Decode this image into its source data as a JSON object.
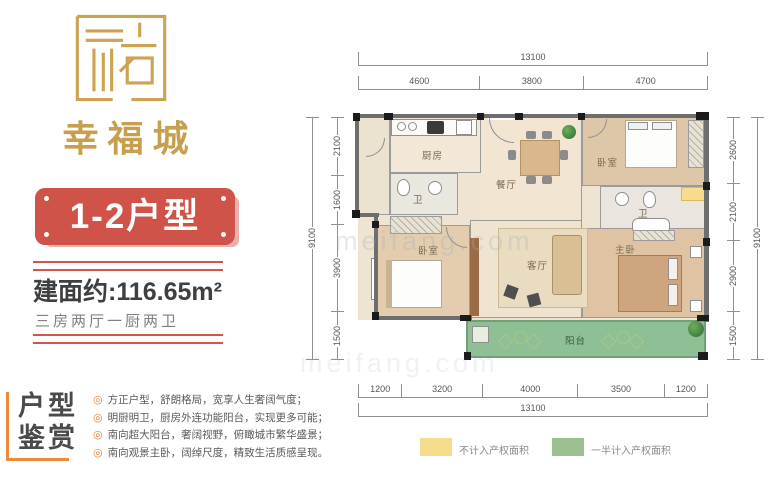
{
  "branding": {
    "logo_text": "幸福城",
    "banner_label": "1-2户型"
  },
  "summary": {
    "area_text": "建面约:116.65m²",
    "layout_text": "三房两厅一厨两卫"
  },
  "appreciation": {
    "title_line1": "户型",
    "title_line2": "鉴赏",
    "items": [
      "方正户型，舒朗格局，宽享人生奢阔气度；",
      "明厨明卫，厨房外连功能阳台，实现更多可能；",
      "南向超大阳台，奢阔视野，俯瞰城市繁华盛景；",
      "南向观景主卧，阔绰尺度，精致生活质感呈现。"
    ]
  },
  "plan": {
    "rooms": {
      "kitchen": "厨房",
      "bath1": "卫",
      "dining": "餐厅",
      "bedroom1": "卧室",
      "bath2": "卫",
      "bedroom2": "卧室",
      "living": "客厅",
      "master": "主卧",
      "balcony": "阳台"
    },
    "dimensions": {
      "top_total": "13100",
      "top_segments": [
        "4600",
        "3800",
        "4700"
      ],
      "left_total": "9100",
      "left_segments": [
        "2100",
        "1600",
        "3900",
        "1500"
      ],
      "right_total": "9100",
      "right_segments": [
        "2600",
        "2100",
        "2900",
        "1500"
      ],
      "bottom_segments": [
        "1200",
        "3200",
        "4000",
        "3500",
        "1200"
      ],
      "bottom_total": "13100"
    },
    "legend": [
      {
        "color": "#f6dd8b",
        "label": "不计入产权面积"
      },
      {
        "color": "#9cbf90",
        "label": "一半计入产权面积"
      }
    ]
  },
  "watermark": "meifang.com",
  "colors": {
    "brand_gold": "#c79f4e",
    "banner_red": "#cf5349",
    "accent_orange": "#ed8b3d",
    "rule_red": "#d5544b",
    "balcony_green": "#8fbf94",
    "flue_yellow": "#f6dd8b"
  }
}
